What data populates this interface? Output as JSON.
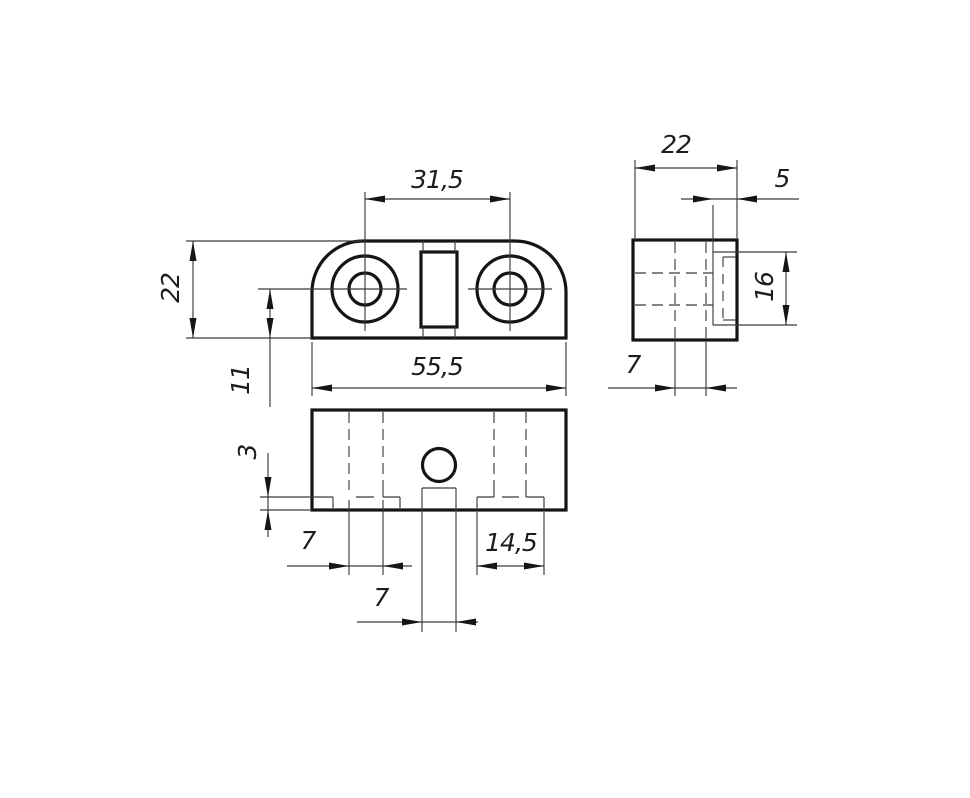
{
  "drawing": {
    "colors": {
      "background": "#ffffff",
      "stroke_main": "#151515",
      "stroke_thin": "#3a3a3a"
    },
    "dimensions": {
      "top": {
        "hole_spacing": "31,5",
        "height": "22",
        "hole_offset": "11",
        "width": "55,5"
      },
      "front": {
        "step_height": "3",
        "hole_diameter": "7",
        "step_width": "14,5",
        "slot_width": "7"
      },
      "side": {
        "depth": "22",
        "slot_depth": "5",
        "slot_height": "16",
        "hole_span": "7"
      }
    }
  }
}
